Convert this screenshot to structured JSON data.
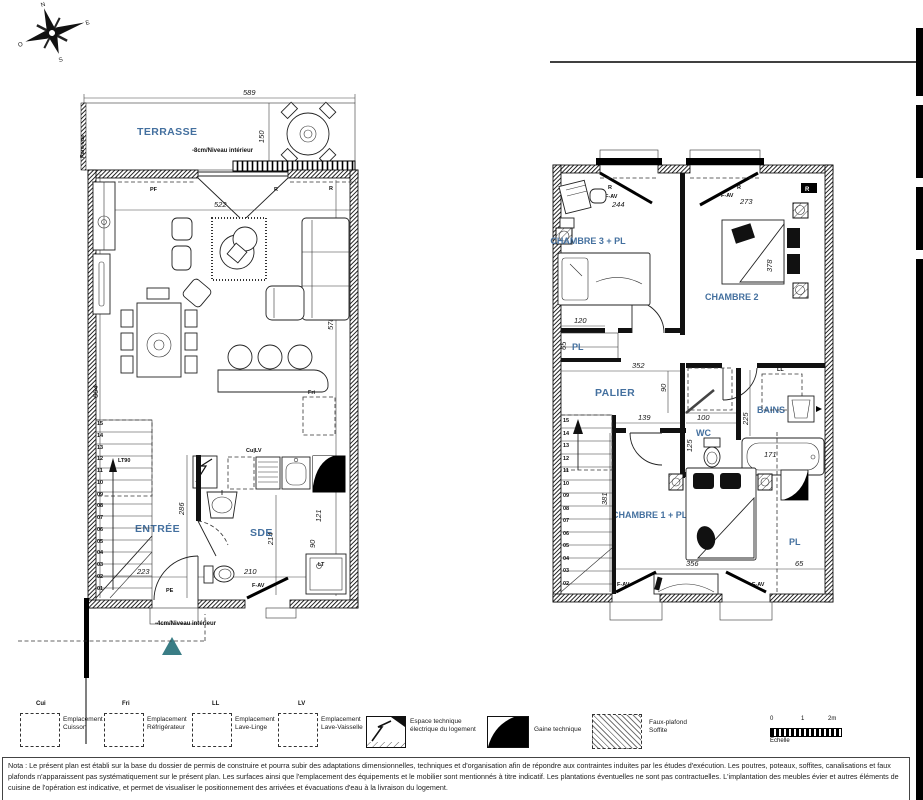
{
  "compass": {
    "n": "N",
    "e": "E",
    "s": "S",
    "o": "O"
  },
  "plan_left": {
    "rooms": {
      "terrasse": "TERRASSE",
      "sejour_cuisine": "SÉJOUR - CUISINE",
      "entree": "ENTRÉE",
      "sde": "SDE"
    },
    "levels": {
      "terrasse": "-8cm/Niveau intérieur",
      "entree": "-4cm/Niveau intérieur"
    },
    "dims": {
      "d589": "589",
      "d150": "150",
      "d522": "522",
      "d578": "578",
      "d664": "664",
      "d286": "286",
      "d223": "223",
      "d210": "210",
      "d214": "214",
      "d121": "121",
      "d90": "90"
    },
    "labels": {
      "pare_vue": "Pare-vue",
      "pe": "PE",
      "fav": "F-AV",
      "cu_lv": "Cu|LV",
      "lt": "LT",
      "lt90": "LT90",
      "pf": "PF",
      "r1": "R",
      "r2": "R",
      "fri": "Fri"
    },
    "stairs": [
      "15",
      "14",
      "13",
      "12",
      "11",
      "10",
      "09",
      "08",
      "07",
      "06",
      "05",
      "04",
      "03",
      "02",
      "01"
    ]
  },
  "plan_right": {
    "rooms": {
      "chambre3": "CHAMBRE 3 + PL",
      "chambre2": "CHAMBRE 2",
      "palier": "PALIER",
      "wc": "WC",
      "bains": "BAINS",
      "chambre1": "CHAMBRE 1 + PL",
      "pl_top": "PL",
      "pl_right": "PL"
    },
    "dims": {
      "d244": "244",
      "d273": "273",
      "d378": "378",
      "d120": "120",
      "d65pl": "65",
      "d352": "352",
      "d90": "90",
      "d139": "139",
      "d100": "100",
      "d125": "125",
      "d225": "225",
      "d171": "171",
      "d356": "356",
      "d65": "65",
      "d381": "381"
    },
    "labels": {
      "fav1": "F-AV",
      "fav2": "F-AV",
      "fav3": "F-AV",
      "fav4": "F-AV",
      "r1": "R",
      "r2": "R",
      "r3": "R",
      "ll": "LL"
    },
    "stairs": [
      "15",
      "14",
      "13",
      "12",
      "11",
      "10",
      "09",
      "08",
      "07",
      "06",
      "05",
      "04",
      "03",
      "02"
    ]
  },
  "legend": {
    "items": [
      {
        "code": "Cui",
        "label": "Emplacement\nCuisson"
      },
      {
        "code": "Fri",
        "label": "Emplacement\nRéfrigérateur"
      },
      {
        "code": "LL",
        "label": "Emplacement\nLave-Linge"
      },
      {
        "code": "LV",
        "label": "Emplacement\nLave-Vaisselle"
      }
    ],
    "tech": [
      {
        "label": "Espace technique\nélectrique du logement"
      },
      {
        "label": "Gaine technique"
      },
      {
        "label": "Faux-plafond\nSoffite"
      }
    ],
    "scale": {
      "t0": "0",
      "t1": "1",
      "t2": "2m",
      "label": "Echelle"
    }
  },
  "note": {
    "text": "Nota : Le présent plan est établi sur la base du dossier de permis de construire et pourra subir des adaptations dimensionnelles, techniques et d'organisation afin de répondre aux contraintes induites par les études d'exécution. Les poutres, poteaux, soffites, canalisations et faux plafonds n'apparaissent pas systématiquement sur le présent plan. Les surfaces ainsi que l'emplacement des équipements et le mobilier sont mentionnés à titre indicatif. Les plantations éventuelles ne sont pas contractuelles. L'implantation des meubles évier et autres éléments de cuisine de l'opération est indicative, et permet de visualiser le positionnement des arrivées et évacuations d'eau à la livraison du logement."
  },
  "colors": {
    "room_label": "#44709f",
    "entrance_triangle": "#3a7d85"
  }
}
